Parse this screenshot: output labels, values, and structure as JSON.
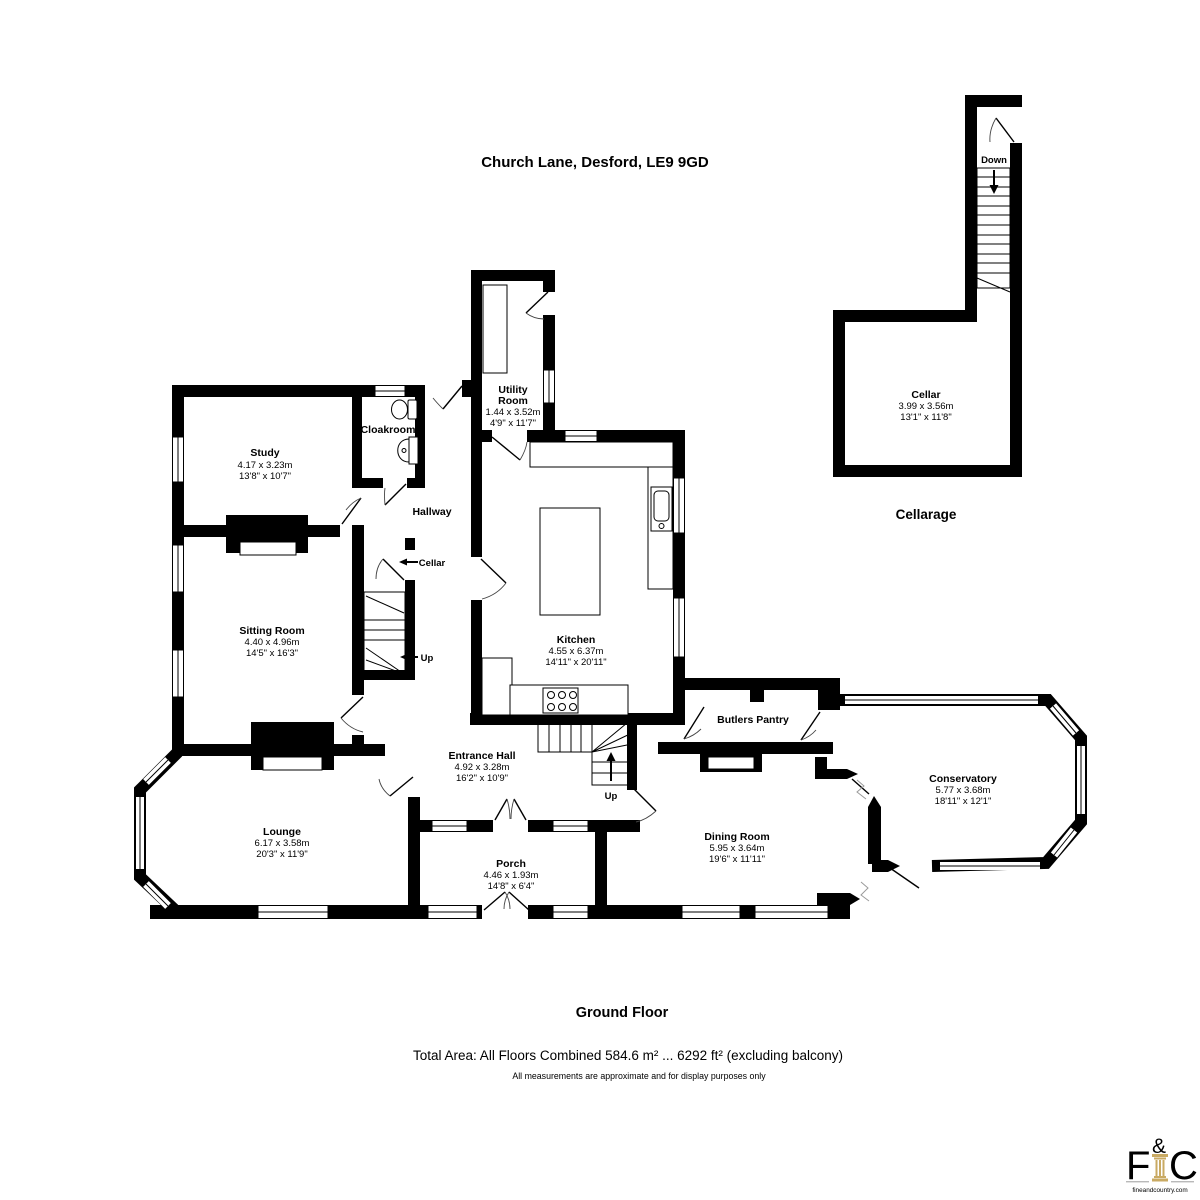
{
  "address_title": "Church Lane, Desford, LE9 9GD",
  "floor": {
    "label": "Ground Floor"
  },
  "sections": {
    "cellarage_label": "Cellarage"
  },
  "totals": {
    "total_area": "Total Area: All Floors Combined 584.6 m² ... 6292 ft² (excluding balcony)",
    "disclaimer": "All measurements are approximate and for display purposes only"
  },
  "rooms": {
    "study": {
      "name": "Study",
      "metric": "4.17 x 3.23m",
      "imperial": "13'8\" x 10'7\""
    },
    "cloakroom": {
      "name": "Cloakroom"
    },
    "utility": {
      "name_line1": "Utility",
      "name_line2": "Room",
      "metric": "1.44 x 3.52m",
      "imperial": "4'9\" x 11'7\""
    },
    "hallway": {
      "name": "Hallway"
    },
    "sitting_room": {
      "name": "Sitting Room",
      "metric": "4.40 x 4.96m",
      "imperial": "14'5\" x 16'3\""
    },
    "kitchen": {
      "name": "Kitchen",
      "metric": "4.55 x 6.37m",
      "imperial": "14'11\" x 20'11\""
    },
    "entrance_hall": {
      "name": "Entrance Hall",
      "metric": "4.92 x 3.28m",
      "imperial": "16'2\" x 10'9\""
    },
    "butlers_pantry": {
      "name": "Butlers Pantry"
    },
    "conservatory": {
      "name": "Conservatory",
      "metric": "5.77 x 3.68m",
      "imperial": "18'11\" x 12'1\""
    },
    "lounge": {
      "name": "Lounge",
      "metric": "6.17 x 3.58m",
      "imperial": "20'3\" x 11'9\""
    },
    "porch": {
      "name": "Porch",
      "metric": "4.46 x 1.93m",
      "imperial": "14'8\" x 6'4\""
    },
    "dining_room": {
      "name": "Dining Room",
      "metric": "5.95 x 3.64m",
      "imperial": "19'6\" x 11'11\""
    },
    "cellar": {
      "name": "Cellar",
      "metric": "3.99 x 3.56m",
      "imperial": "13'1\" x 11'8\""
    }
  },
  "annotations": {
    "cellar_door": "Cellar",
    "up_label": "Up",
    "down_label": "Down"
  },
  "branding": {
    "initial_f": "F",
    "ampersand": "&",
    "initial_c": "C",
    "website": "fineandcountry.com"
  },
  "colors": {
    "wall": "#000000",
    "background": "#ffffff",
    "logo_gray": "#9a9a9a",
    "logo_gold": "#c2a35c"
  }
}
